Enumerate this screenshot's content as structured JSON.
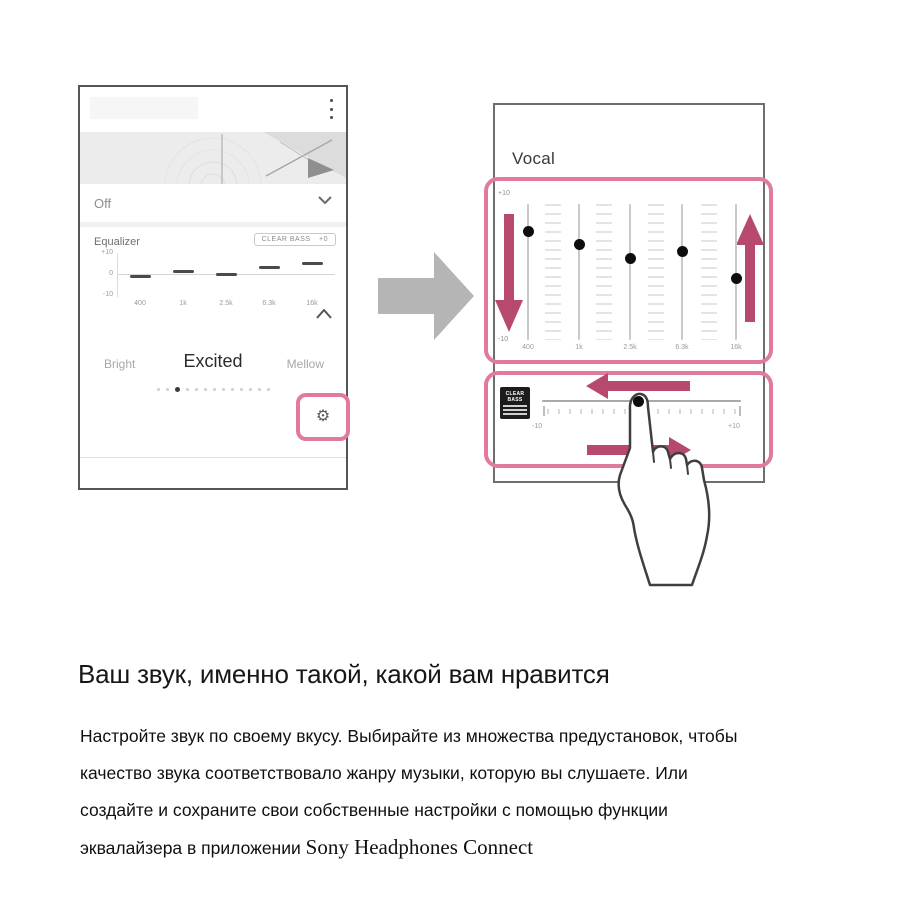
{
  "phone": {
    "off_label": "Off",
    "equalizer": {
      "title": "Equalizer",
      "clear_bass_label": "CLEAR BASS",
      "clear_bass_value": "+0",
      "y_labels": [
        "+10",
        "0",
        "-10"
      ],
      "bands": [
        "400",
        "1k",
        "2.5k",
        "6.3k",
        "16k"
      ],
      "values_db": [
        -1,
        1,
        0,
        3,
        5
      ],
      "range": [
        -10,
        10
      ]
    },
    "presets": {
      "left": "Bright",
      "selected": "Excited",
      "right": "Mellow"
    },
    "pagination": {
      "count": 13,
      "active_index": 2
    },
    "gear_icon": "⚙"
  },
  "detail_panel": {
    "preset_name": "Vocal",
    "eq": {
      "top_label": "+10",
      "bottom_label": "-10",
      "bands": [
        "400",
        "1k",
        "2.5k",
        "6.3k",
        "16k"
      ],
      "values_db": [
        6,
        4,
        2,
        3,
        -1
      ],
      "range": [
        -10,
        10
      ]
    },
    "clear_bass": {
      "badge_lines": [
        "CLEAR",
        "BASS"
      ],
      "min_label": "-10",
      "max_label": "+10",
      "value_fraction": 0.485,
      "range": [
        -10,
        10
      ]
    }
  },
  "caption": {
    "heading": "Ваш звук, именно такой, какой вам нравится",
    "lines": [
      "Настройте звук по своему вкусу. Выбирайте из множества предустановок, чтобы",
      "качество звука соответствовало жанру музыки, которую вы слушаете. Или",
      "создайте и сохраните свои собственные настройки с помощью функции",
      "эквалайзера в приложении "
    ],
    "app_name": "Sony Headphones Connect"
  },
  "colors": {
    "pink_outline": "#e07a9f",
    "pink_arrow": "#b7496f",
    "gray_arrow": "#b5b5b5",
    "handle_black": "#0d0d0d"
  }
}
